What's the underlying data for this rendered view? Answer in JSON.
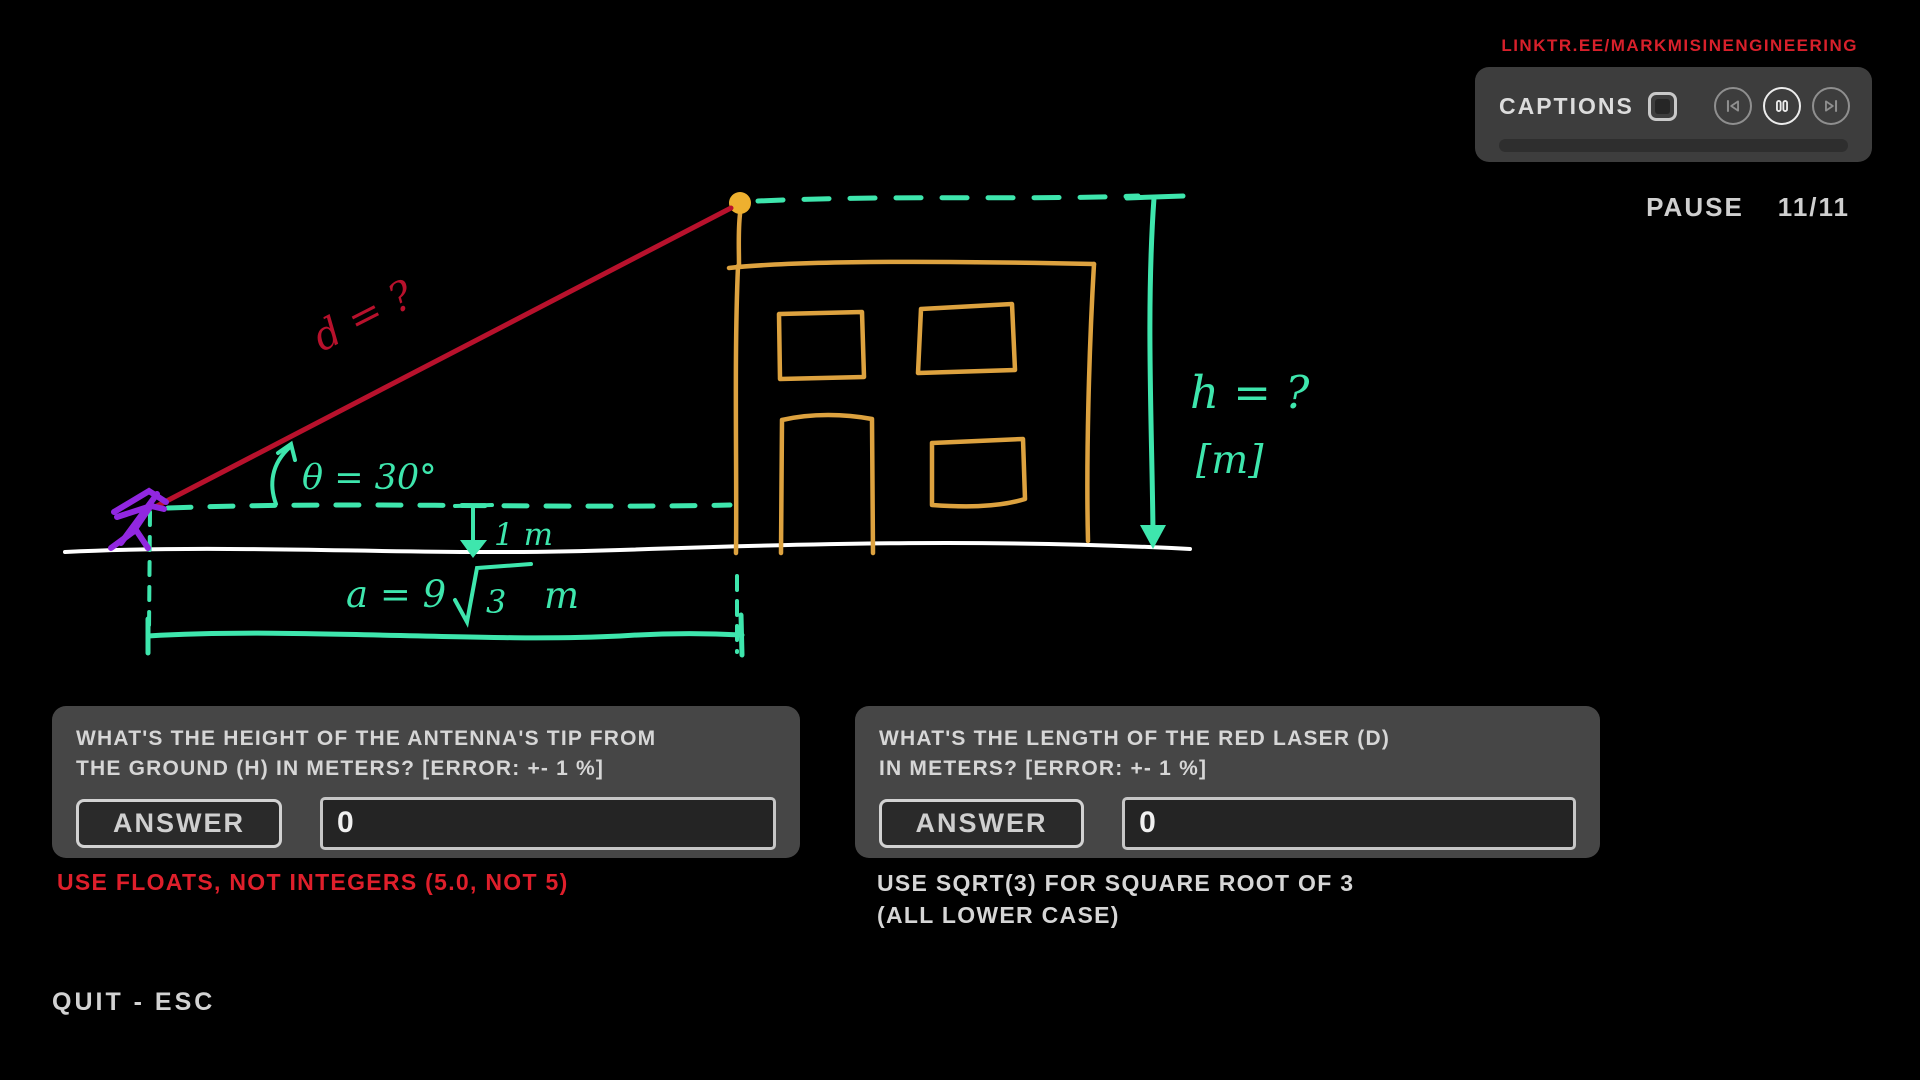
{
  "link": {
    "text": "LINKTR.EE/MARKMISINENGINEERING",
    "color": "#d8202b"
  },
  "player": {
    "captions_label": "CAPTIONS",
    "captions_checkbox": "unchecked",
    "media_icons": [
      "skip-back-icon",
      "pause-icon",
      "skip-forward-icon"
    ],
    "status": "PAUSE",
    "progress": "11/11"
  },
  "diagram": {
    "labels": {
      "laser": "d = ?",
      "angle": "θ = 30°",
      "height": "h = ?",
      "height_unit": "[m]",
      "offset": "1 m",
      "base_full": "a = 9√3 m",
      "base_prefix": "a = 9",
      "base_radicand": "3",
      "base_unit": "m"
    },
    "colors": {
      "teal": "#3ee6ad",
      "orange": "#dda23f",
      "dot": "#eeb02f",
      "laser": "#b8112c",
      "purple": "#9127e0",
      "ground": "#ffffff"
    }
  },
  "questions": [
    {
      "lines": [
        "WHAT'S THE HEIGHT OF THE ANTENNA'S TIP FROM",
        "THE GROUND (H) IN METERS? [ERROR: +- 1 %]"
      ],
      "button_label": "ANSWER",
      "value": "0"
    },
    {
      "lines": [
        "WHAT'S THE LENGTH OF THE RED LASER (D)",
        "IN METERS? [ERROR: +- 1 %]"
      ],
      "button_label": "ANSWER",
      "value": "0"
    }
  ],
  "notes": {
    "floats": "USE FLOATS, NOT INTEGERS (5.0, NOT 5)",
    "sqrt_lines": [
      "USE SQRT(3) FOR SQUARE ROOT OF 3",
      "(ALL LOWER CASE)"
    ]
  },
  "footer": {
    "quit": "QUIT - ESC"
  }
}
